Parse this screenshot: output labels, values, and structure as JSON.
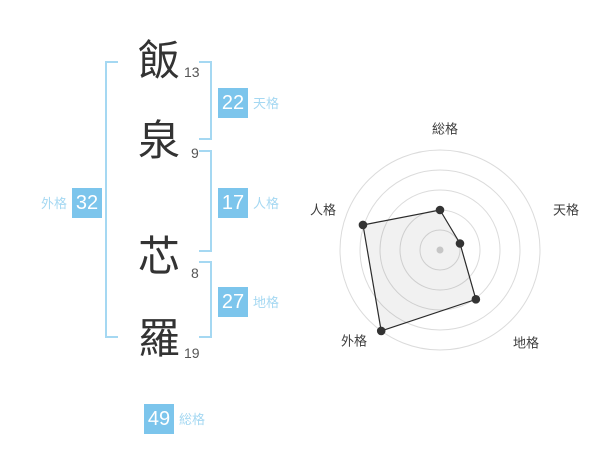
{
  "title": "姓名判断 画数表示",
  "name": {
    "chars": [
      {
        "char": "飯",
        "strokes": "13"
      },
      {
        "char": "泉",
        "strokes": "9"
      },
      {
        "char": "芯",
        "strokes": "8"
      },
      {
        "char": "羅",
        "strokes": "19"
      }
    ]
  },
  "kaku": {
    "tenkaku": {
      "value": "22",
      "label": "天格"
    },
    "jinkaku": {
      "value": "17",
      "label": "人格"
    },
    "chikaku": {
      "value": "27",
      "label": "地格"
    },
    "gaikaku": {
      "value": "32",
      "label": "外格"
    },
    "soukaku": {
      "value": "49",
      "label": "総格"
    }
  },
  "colors": {
    "box": "#7CC5EC",
    "lightblue": "#A5D8F2",
    "bracket": "#A5D8F2",
    "ink": "#333333",
    "stroke-num": "#555555",
    "ring": "#DBDBDB",
    "poly": "#2B2B2B",
    "point": "#333333",
    "dot": "#C6C6C6",
    "chart-label": "#3D3D3D"
  },
  "chart_data": {
    "type": "radar",
    "title": "",
    "categories": [
      "総格",
      "天格",
      "地格",
      "外格",
      "人格"
    ],
    "values": [
      40,
      21,
      61,
      100,
      81
    ],
    "max": 100,
    "rings": 5,
    "grid": "concentric-circles",
    "legend": false,
    "layout": {
      "center_x": 440,
      "center_y": 250,
      "radius": 100,
      "start_angle_deg": 90,
      "clockwise": true,
      "label_anchors": [
        {
          "x": 445,
          "y": 129
        },
        {
          "x": 566,
          "y": 210
        },
        {
          "x": 526,
          "y": 343
        },
        {
          "x": 354,
          "y": 341
        },
        {
          "x": 323,
          "y": 210
        }
      ]
    }
  }
}
